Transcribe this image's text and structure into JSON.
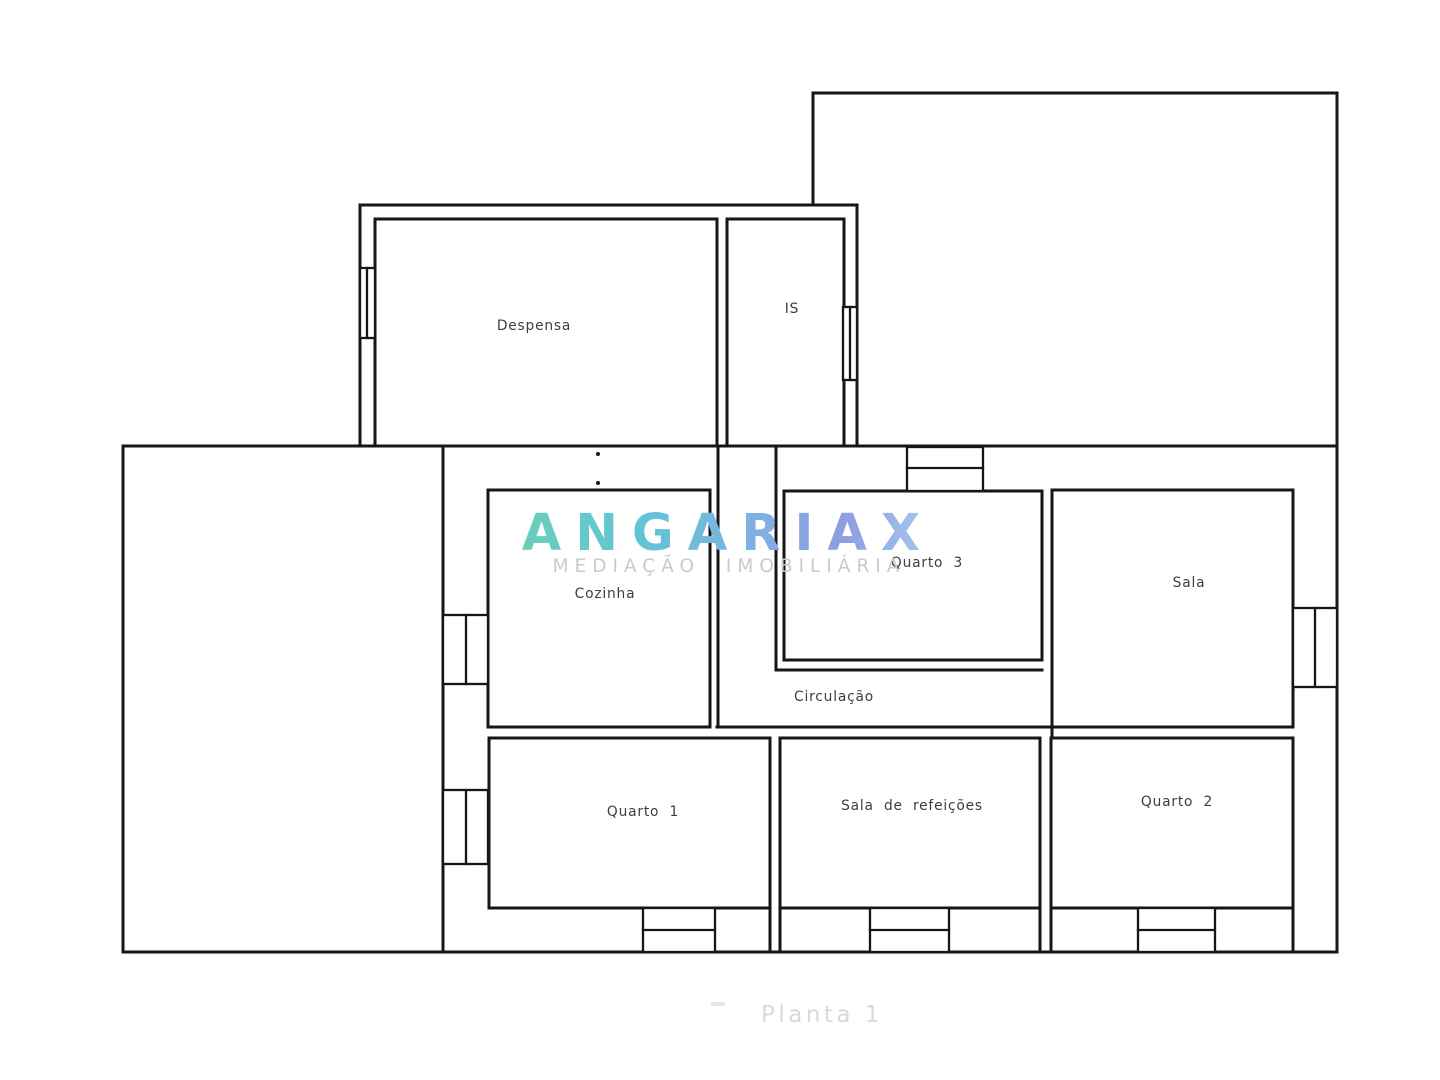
{
  "page": {
    "background": "#ffffff"
  },
  "floorplan": {
    "line_color": "#161616",
    "label_color": "#3e3e3e",
    "rooms": [
      {
        "id": "despensa",
        "label": "Despensa"
      },
      {
        "id": "is",
        "label": "IS"
      },
      {
        "id": "cozinha",
        "label": "Cozinha"
      },
      {
        "id": "quarto-3",
        "label": "Quarto 3"
      },
      {
        "id": "sala",
        "label": "Sala"
      },
      {
        "id": "circulacao",
        "label": "Circulação"
      },
      {
        "id": "quarto-1",
        "label": "Quarto 1"
      },
      {
        "id": "sala-de-refeicoes",
        "label": "Sala de refeições"
      },
      {
        "id": "quarto-2",
        "label": "Quarto 2"
      }
    ]
  },
  "watermark": {
    "brand": "ANGARIAX",
    "tagline": "MEDIAÇÃO IMOBILIÁRIA",
    "tagline_color": "#c8cacc",
    "gradient": {
      "start": "#6bcdbb",
      "teal": "#5fc6d4",
      "mid": "#7fb1e2",
      "indigo": "#8f9de1",
      "end": "#a6c9ee"
    }
  },
  "caption": {
    "label": "Planta 1",
    "color": "#d8d9da"
  }
}
